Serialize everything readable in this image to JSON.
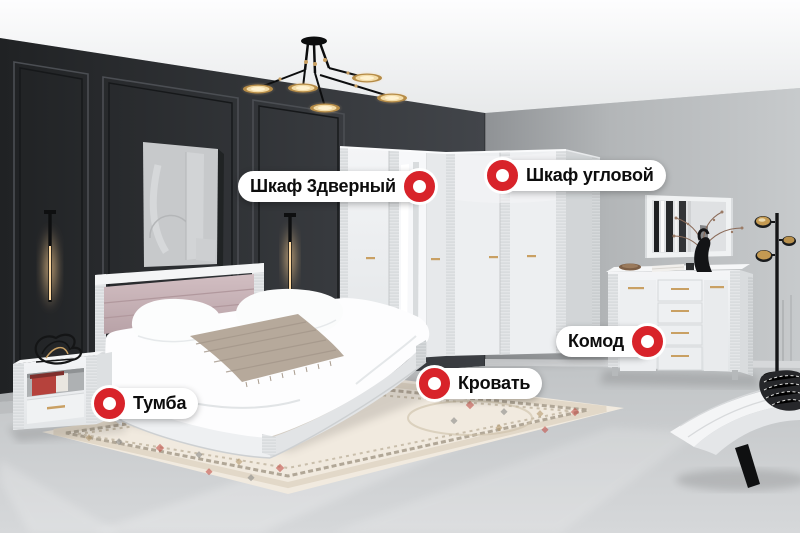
{
  "hotspots": {
    "wardrobe_3door": {
      "label": "Шкаф 3дверный",
      "marker_icon": "hotspot-marker",
      "marker_side": "right"
    },
    "wardrobe_corner": {
      "label": "Шкаф угловой",
      "marker_icon": "hotspot-marker",
      "marker_side": "left"
    },
    "dresser": {
      "label": "Комод",
      "marker_icon": "hotspot-marker",
      "marker_side": "right"
    },
    "bed": {
      "label": "Кровать",
      "marker_icon": "hotspot-marker",
      "marker_side": "left"
    },
    "nightstand": {
      "label": "Тумба",
      "marker_icon": "hotspot-marker",
      "marker_side": "left"
    }
  },
  "colors": {
    "marker_red": "#D8232A",
    "pill_bg": "#FFFFFF",
    "label_text": "#0D0D0D",
    "dark_wall": "#2E3033",
    "light_wall": "#B7BABC",
    "ceiling": "#F4F5F6",
    "floor": "#C8CBCD",
    "furniture_white": "#EEF0F1",
    "headboard_pink": "#C9B4B8",
    "gold_accent": "#C9A063"
  }
}
